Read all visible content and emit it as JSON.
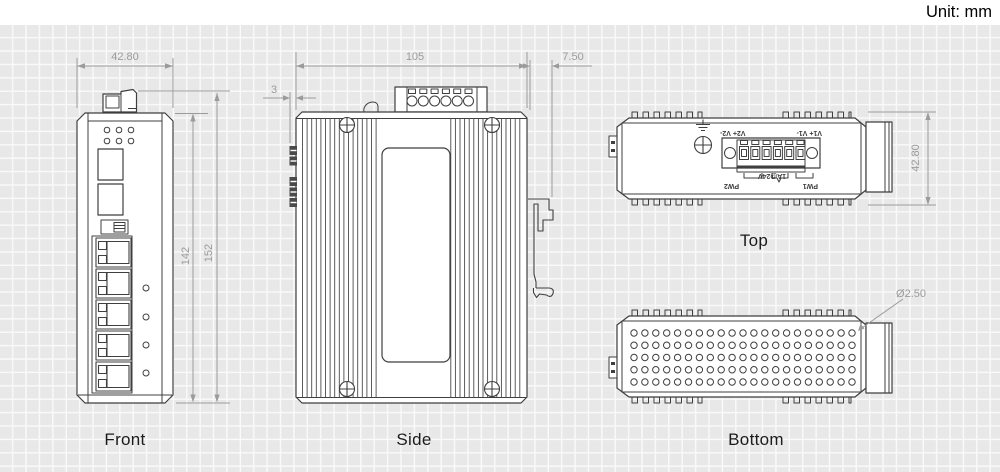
{
  "unit_label": "Unit: mm",
  "views": {
    "front": {
      "label": "Front",
      "dim_width": "42.80",
      "dim_height_inner": "142",
      "dim_height_outer": "152"
    },
    "side": {
      "label": "Side",
      "dim_width": "105",
      "dim_clip_depth": "7.50",
      "dim_tab_offset": "3"
    },
    "top": {
      "label": "Top",
      "dim_height": "42.80",
      "terminals": {
        "group_v1": "V1+ V1-",
        "group_v2": "V2+ V2-",
        "pw1": "PW1",
        "pw2": "PW2",
        "rating": "1A@24V"
      }
    },
    "bottom": {
      "label": "Bottom",
      "dim_hole_diameter": "Ø2.50"
    }
  },
  "colors": {
    "line": "#3f3f3f",
    "dimension": "#9b9b9b",
    "grid_background": "#e8e8e8",
    "grid_line": "#fbfbfb"
  }
}
